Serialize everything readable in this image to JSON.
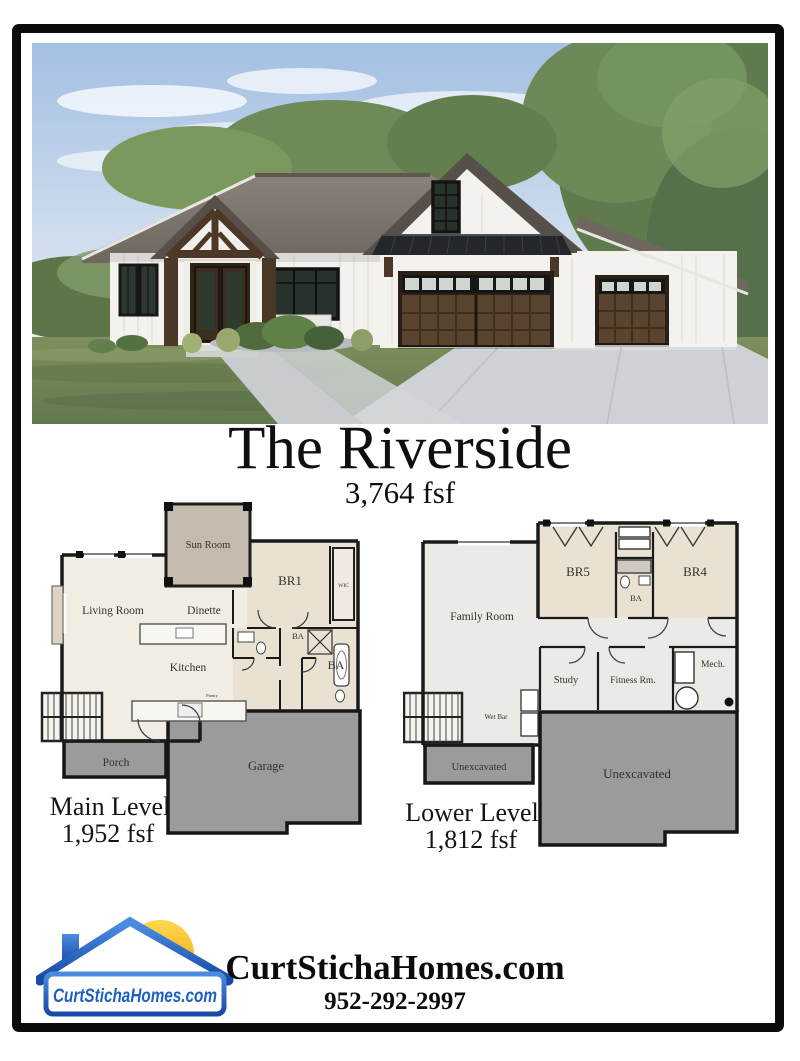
{
  "title": {
    "text": "The Riverside",
    "subtitle": "3,764 fsf"
  },
  "plans": {
    "main": {
      "caption": "Main Level",
      "area": "1,952 fsf",
      "rooms": {
        "sun_room": "Sun Room",
        "living_room": "Living Room",
        "dinette": "Dinette",
        "br1": "BR1",
        "wic": "WIC",
        "kitchen": "Kitchen",
        "pantry": "Pantry",
        "ba_hall": "BA",
        "ba_primary": "BA",
        "porch": "Porch",
        "garage": "Garage"
      }
    },
    "lower": {
      "caption": "Lower Level",
      "area": "1,812 fsf",
      "rooms": {
        "family_room": "Family Room",
        "br5": "BR5",
        "br4": "BR4",
        "ba": "BA",
        "study": "Study",
        "fitness_room": "Fitness Rm.",
        "mech": "Mech.",
        "wet_bar": "Wet Bar",
        "unexcavated_left": "Unexcavated",
        "unexcavated_right": "Unexcavated"
      }
    }
  },
  "footer": {
    "logo_text": "CurtStichaHomes.com",
    "website": "CurtStichaHomes.com",
    "phone": "952-292-2997"
  },
  "colors": {
    "frame": "#0b0b0b",
    "logo_blue": "#1e5fc4",
    "sun_yellow": "#f6a71b",
    "plan_dark": "#9b9b9b",
    "plan_cream": "#f1ede2",
    "plan_tan": "#c4bbae",
    "plan_beige": "#e9e2d3",
    "plan_gray": "#eceae6",
    "wall": "#1a1a1a"
  }
}
